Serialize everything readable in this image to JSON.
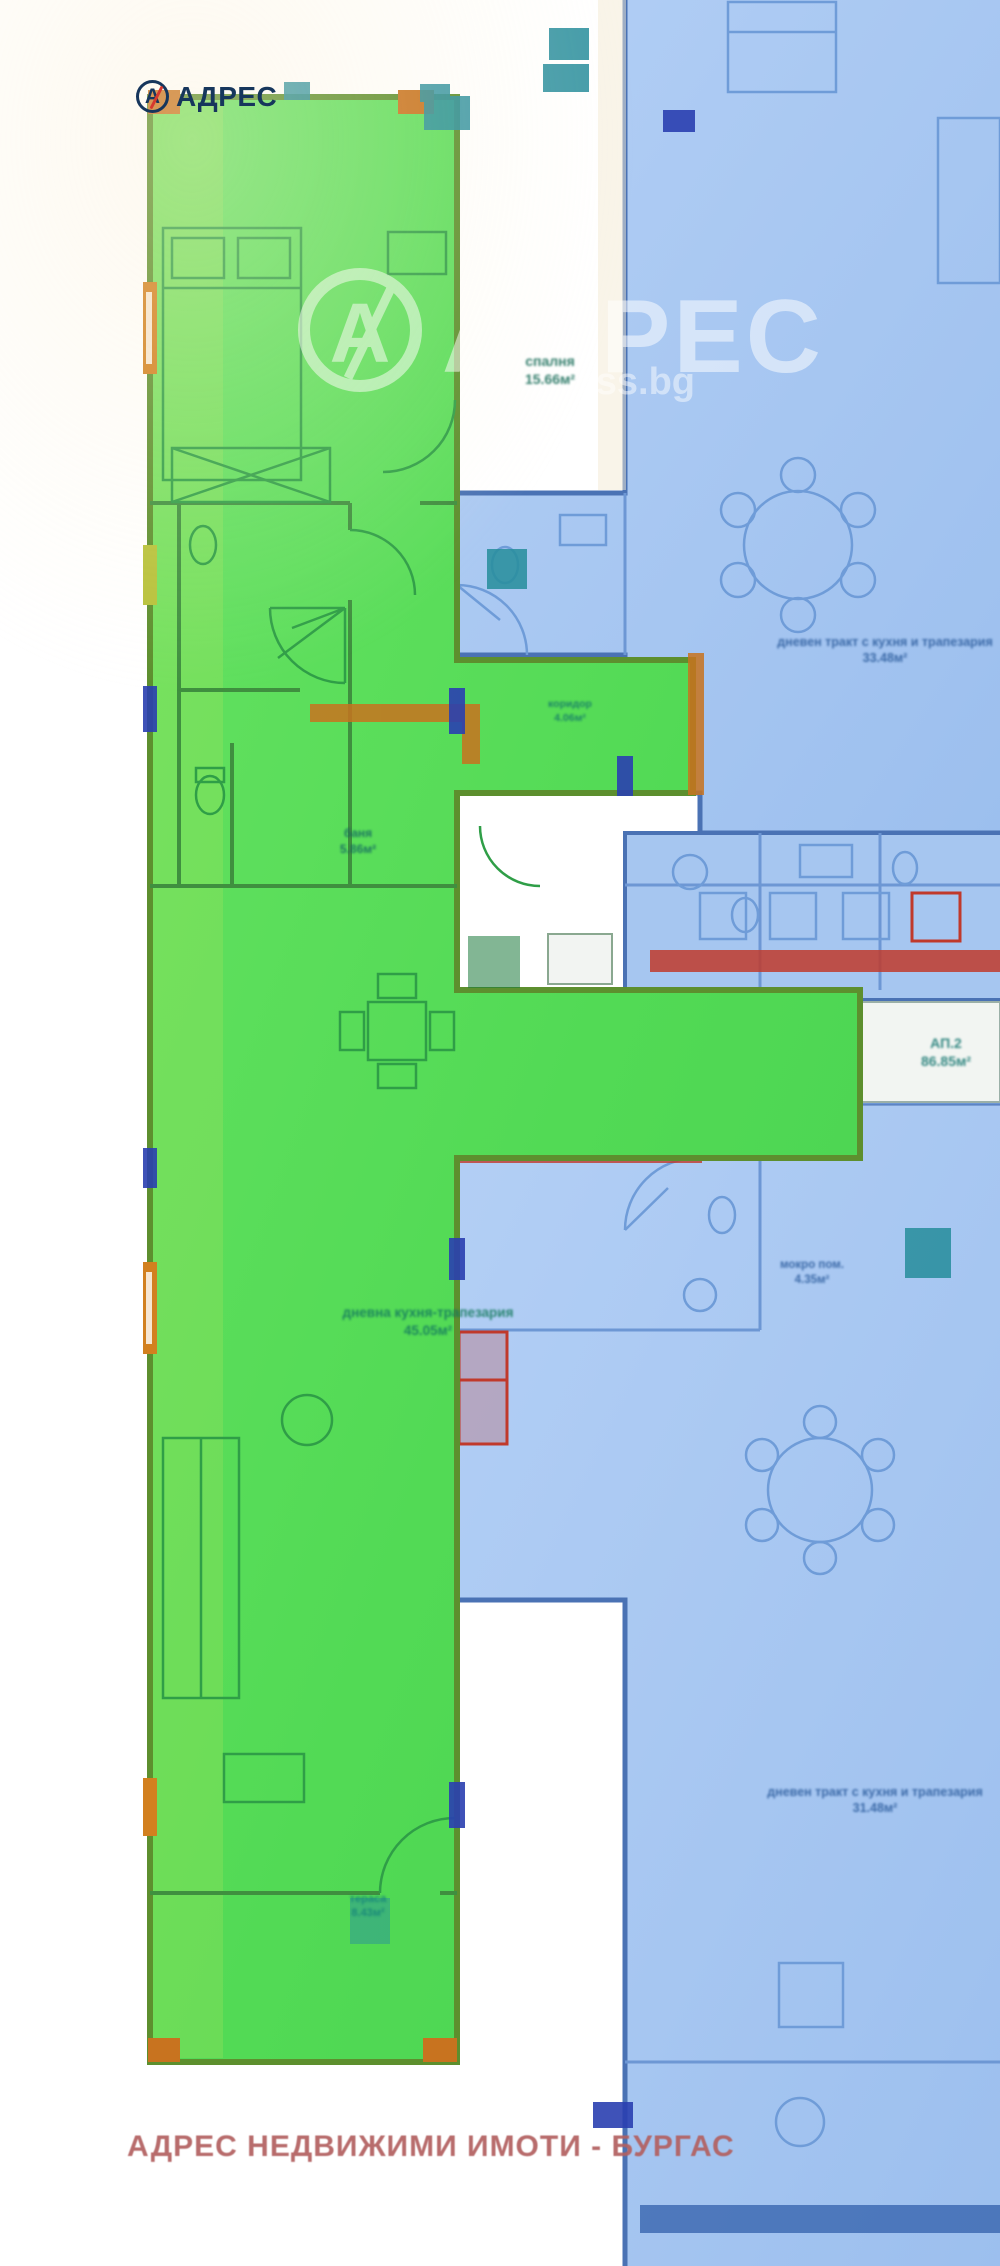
{
  "logo": {
    "icon_letter": "А",
    "text": "АДРЕС"
  },
  "watermark": {
    "icon_letter": "А",
    "brand_text": "АДРЕС",
    "site_text": "address.bg"
  },
  "footer": {
    "text": "АДРЕС НЕДВИЖИМИ ИМОТИ - БУРГАС"
  },
  "colors": {
    "highlight_green": "#54da56",
    "adjacent_blue": "#a9c8f0",
    "wall_red": "#c0392b",
    "wall_orange": "#c8731f",
    "marker_teal": "#2a8f9e",
    "marker_navy": "#2a3fb0",
    "logo_navy": "#16365c",
    "logo_red": "#d6392e",
    "footer_rose": "#b26060"
  },
  "floorplan": {
    "labels": [
      {
        "id": "bedroom",
        "lines": [
          "спалня",
          "15.66м²"
        ],
        "x": 550,
        "y": 352,
        "size": 14,
        "color": "#1a6e5a"
      },
      {
        "id": "bathroom",
        "lines": [
          "баня",
          "5.86м²"
        ],
        "x": 358,
        "y": 826,
        "size": 12,
        "color": "#156a60"
      },
      {
        "id": "hallway",
        "lines": [
          "коридор",
          "4.06м²"
        ],
        "x": 570,
        "y": 698,
        "size": 10.5,
        "color": "#157a68"
      },
      {
        "id": "living-room",
        "lines": [
          "дневна кухня-трапезария",
          "45.05м²"
        ],
        "x": 428,
        "y": 1304,
        "size": 13.5,
        "color": "#157a5e"
      },
      {
        "id": "terrace",
        "lines": [
          "тераса",
          "8.43м²"
        ],
        "x": 368,
        "y": 1892,
        "size": 11,
        "color": "#17857a"
      },
      {
        "id": "blue-top-living",
        "lines": [
          "дневен тракт с кухня и трапезария",
          "33.48м²"
        ],
        "x": 885,
        "y": 634,
        "size": 12.5,
        "color": "#2e5e9e"
      },
      {
        "id": "blue-wc",
        "lines": [
          "мокро пом.",
          "4.35м²"
        ],
        "x": 812,
        "y": 1258,
        "size": 11.5,
        "color": "#2e5e9e"
      },
      {
        "id": "blue-bottom-living",
        "lines": [
          "дневен тракт с кухня и трапезария",
          "31.48м²"
        ],
        "x": 875,
        "y": 1784,
        "size": 12.5,
        "color": "#2e5e9e"
      },
      {
        "id": "unit-badge",
        "lines": [
          "АП.2",
          "86.85м²"
        ],
        "x": 946,
        "y": 1034,
        "size": 14,
        "color": "#1b7a74"
      }
    ]
  }
}
